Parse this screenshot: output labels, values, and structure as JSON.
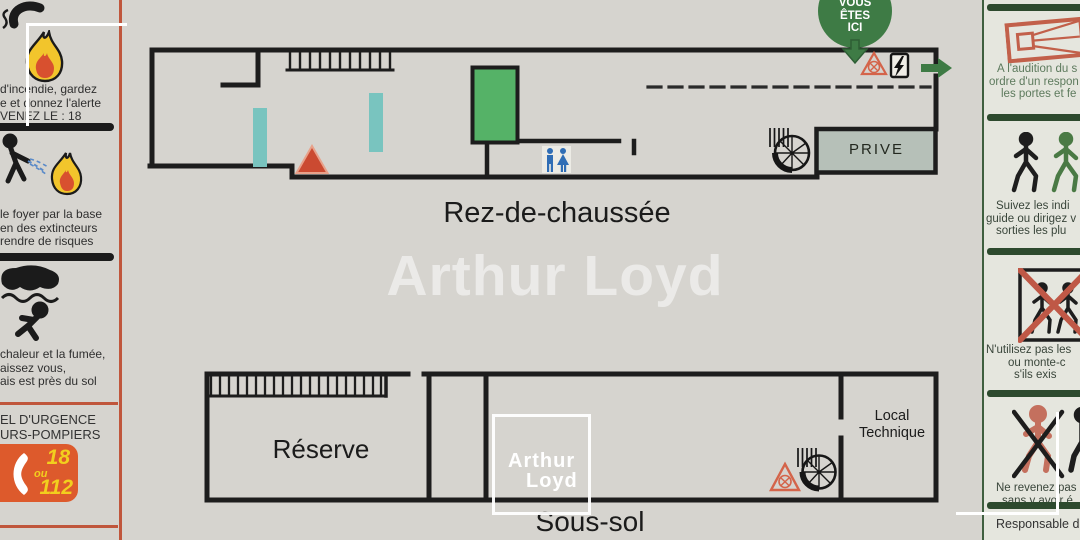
{
  "left_panel": {
    "section_fire": {
      "lines": [
        "d'incendie, gardez",
        "e et donnez l'alerte",
        "VENEZ LE : 18"
      ]
    },
    "section_extinguisher": {
      "lines": [
        "le foyer par la base",
        "en des extincteurs",
        "rendre de risques"
      ]
    },
    "section_smoke": {
      "lines": [
        "chaleur et la fumée,",
        "aissez vous,",
        "ais est près du sol"
      ]
    },
    "emergency": {
      "title_lines": [
        "EL D'URGENCE",
        "URS-POMPIERS"
      ],
      "number_primary": "18",
      "conjunction": "ou",
      "number_secondary": "112"
    }
  },
  "plans": {
    "ground_floor": {
      "label": "Rez-de-chaussée",
      "room_prive": "PRIVE",
      "you_are_here": [
        "VOUS",
        "ÊTES",
        "ICI"
      ]
    },
    "basement": {
      "label": "Sous-sol",
      "room_reserve": "Réserve",
      "room_local_technique": [
        "Local",
        "Technique"
      ]
    }
  },
  "watermark": {
    "text": "Arthur Loyd"
  },
  "logo": {
    "line1": "Arthur",
    "line2": "Loyd"
  },
  "right_panel": {
    "section_alarm": {
      "lines": [
        "A l'audition du s",
        "ordre d'un respon",
        "les portes et fe"
      ]
    },
    "section_follow": {
      "lines": [
        "Suivez les indi",
        "guide ou dirigez v",
        "sorties les plu"
      ]
    },
    "section_no_elevator": {
      "lines": [
        "N'utilisez pas les",
        "ou monte-c",
        "s'ils exis"
      ]
    },
    "section_no_return": {
      "lines": [
        "Ne revenez pas",
        "sans y avoir é"
      ]
    },
    "footer": "Responsable d'"
  },
  "colors": {
    "accent_green": "#3e7b45",
    "accent_orange": "#dd5a2c",
    "alert_red": "#cb4a31",
    "teal": "#79c4bf",
    "room_green": "#55b267",
    "prive_fill": "#b6c0b8",
    "panel_border_red": "#c0563c",
    "panel_border_green": "#3f5f3f"
  }
}
